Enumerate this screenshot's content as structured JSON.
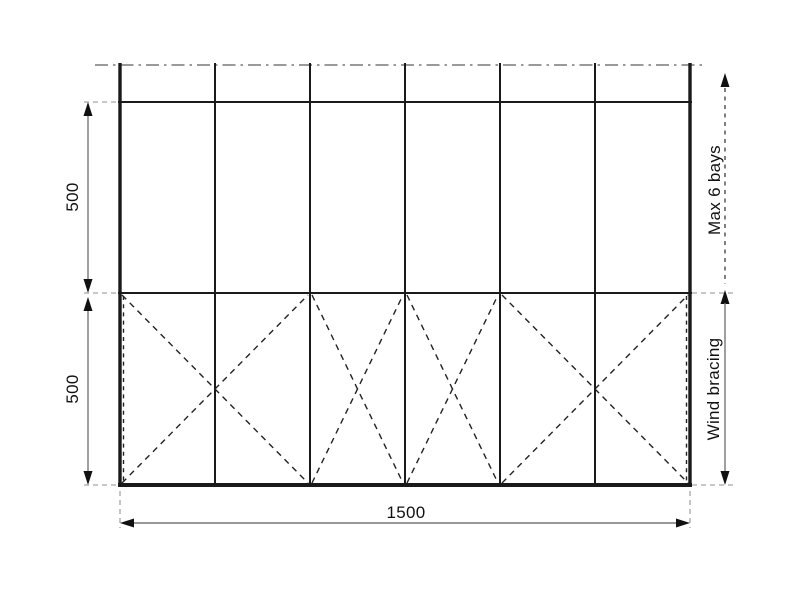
{
  "labels": {
    "dim_upper_height": "500",
    "dim_lower_height": "500",
    "dim_total_width": "1500",
    "max_bays": "Max 6 bays",
    "wind_bracing": "Wind bracing"
  },
  "structure": {
    "bay_count": 6,
    "braced_bays": "X-bracing: double-bay X (bays 1-2), single-bay X (bay 3), single-bay X (bay 4), double-bay X (bays 5-6)"
  },
  "colors": {
    "background": "#ffffff",
    "structure_line": "#1a1a1a",
    "bracing_line": "#222222",
    "dimension_line": "#777777",
    "extension_line": "#a6a6a6",
    "centerline": "#8c8c8c",
    "text": "#111111",
    "arrowhead": "#111111"
  }
}
